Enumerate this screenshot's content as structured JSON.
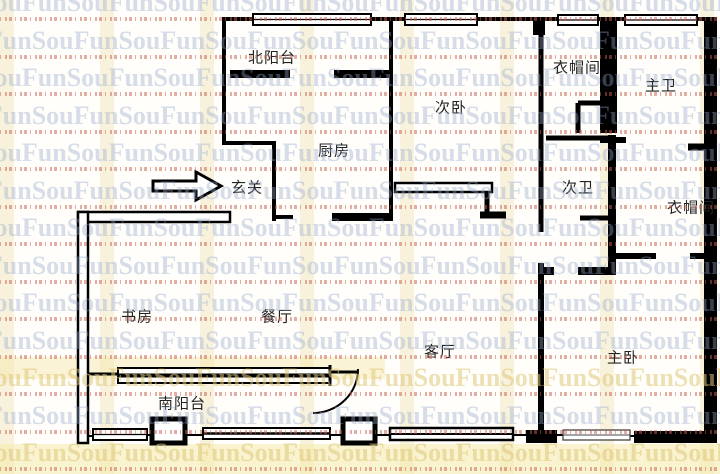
{
  "plan": {
    "rooms": [
      {
        "id": "north-balcony",
        "label": "北阳台",
        "x": 272,
        "y": 57
      },
      {
        "id": "second-bedroom",
        "label": "次卧",
        "x": 451,
        "y": 107
      },
      {
        "id": "cloakroom-top",
        "label": "衣帽间",
        "x": 577,
        "y": 67
      },
      {
        "id": "master-bath",
        "label": "主卫",
        "x": 661,
        "y": 85
      },
      {
        "id": "kitchen",
        "label": "厨房",
        "x": 334,
        "y": 150
      },
      {
        "id": "entry",
        "label": "玄关",
        "x": 247,
        "y": 187
      },
      {
        "id": "second-bath",
        "label": "次卫",
        "x": 578,
        "y": 187
      },
      {
        "id": "cloakroom-right",
        "label": "衣帽间",
        "x": 691,
        "y": 207
      },
      {
        "id": "study",
        "label": "书房",
        "x": 137,
        "y": 316
      },
      {
        "id": "dining",
        "label": "餐厅",
        "x": 277,
        "y": 316
      },
      {
        "id": "living",
        "label": "客厅",
        "x": 440,
        "y": 351
      },
      {
        "id": "master-bedroom",
        "label": "主卧",
        "x": 623,
        "y": 357
      },
      {
        "id": "south-balcony",
        "label": "南阳台",
        "x": 182,
        "y": 403
      }
    ]
  },
  "watermark": {
    "text": "SouFun"
  },
  "colors": {
    "wall": "#000000",
    "label": "#222222",
    "watermark_blue": "rgba(148,168,205,0.38)",
    "watermark_red": "rgba(198,94,76,0.5)",
    "stripe_yellow": "rgba(246,238,210,0.75)"
  }
}
